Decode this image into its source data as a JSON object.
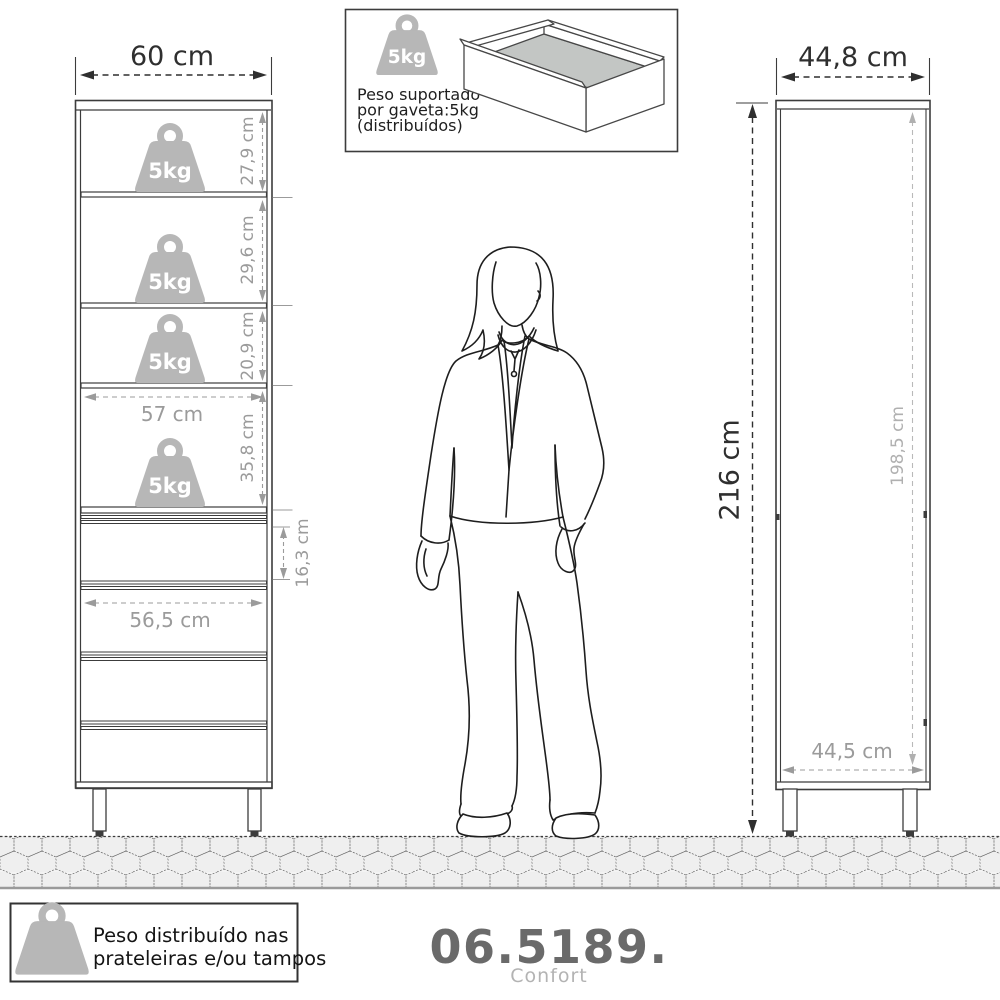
{
  "front_view": {
    "width_label": "60 cm",
    "inner_width": "57 cm",
    "drawer_width": "56,5 cm",
    "drawer_height": "16,3 cm",
    "sections": [
      {
        "weight": "5kg",
        "height": "27,9 cm"
      },
      {
        "weight": "5kg",
        "height": "29,6 cm"
      },
      {
        "weight": "5kg",
        "height": "20,9 cm"
      },
      {
        "weight": "5kg",
        "height": "35,8 cm"
      }
    ]
  },
  "side_view": {
    "width": "44,8 cm",
    "height": "216 cm",
    "inner_height": "198,5 cm",
    "depth": "44,5 cm"
  },
  "drawer_note": {
    "weight": "5kg",
    "line1": "Peso suportado",
    "line2": "por gaveta:5kg",
    "line3": "(distribuídos)"
  },
  "shelf_note": {
    "line1": "Peso distribuído nas",
    "line2": "prateleiras e/ou tampos"
  },
  "product": {
    "code": "06.5189.",
    "name": "Confort"
  },
  "colors": {
    "line": "#3c3c3c",
    "dim_gray": "#9b9b9b",
    "weight_gray": "#b7b7b7"
  }
}
